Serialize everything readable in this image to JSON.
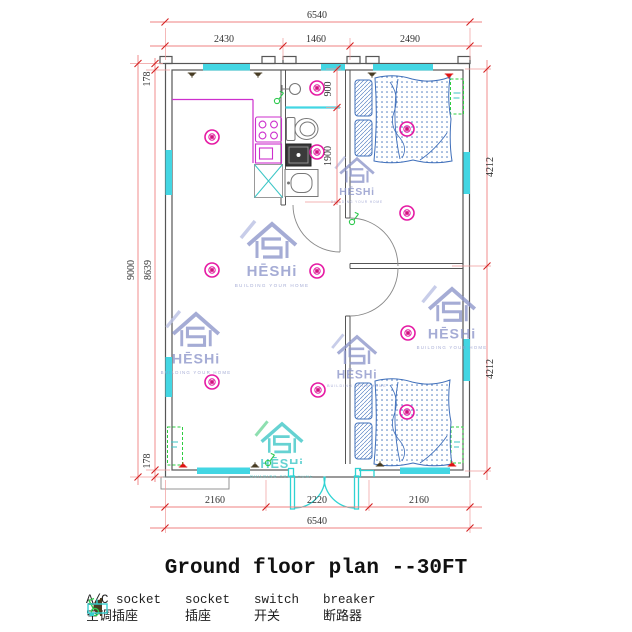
{
  "title": "Ground floor plan --30FT",
  "watermark": {
    "brand": "HĒSHi",
    "tagline": "BUILDING YOUR HOME"
  },
  "dimensions": {
    "top": {
      "overall": "6540",
      "segments": [
        "2430",
        "1460",
        "2490"
      ]
    },
    "bottom": {
      "overall": "6540",
      "segments": [
        "2160",
        "2220",
        "2160"
      ]
    },
    "left": {
      "overall": "9000",
      "inner": "8639",
      "wall_top": "178",
      "wall_bottom": "178"
    },
    "right": {
      "upper": "4212",
      "lower": "4212"
    },
    "bathroom": {
      "upper": "900",
      "lower": "1900"
    }
  },
  "legend": [
    {
      "name": "ac-socket",
      "en": "A/C socket",
      "zh": "空调插座",
      "color": "#e01212"
    },
    {
      "name": "socket",
      "en": "socket",
      "zh": "插座",
      "color": "#473b22"
    },
    {
      "name": "switch",
      "en": "switch",
      "zh": "开关",
      "color": "#2fc94f"
    },
    {
      "name": "breaker",
      "en": "breaker",
      "zh": "断路器",
      "color": "#36cfcf"
    }
  ],
  "colors": {
    "wall": "#565656",
    "window": "#43d6e3",
    "dimension_line": "#ef8080",
    "dimension_tick": "#d42020",
    "dimension_text": "#323232",
    "ceiling_light": "#e519a3",
    "kitchen": "#cd2fcd",
    "bed": "#3f6fba",
    "entry_door": "#2fd3d3",
    "breaker_box": "#2ecc40",
    "watermark_blue": "#8d95ca",
    "watermark_teal": "#3cc6c6"
  }
}
